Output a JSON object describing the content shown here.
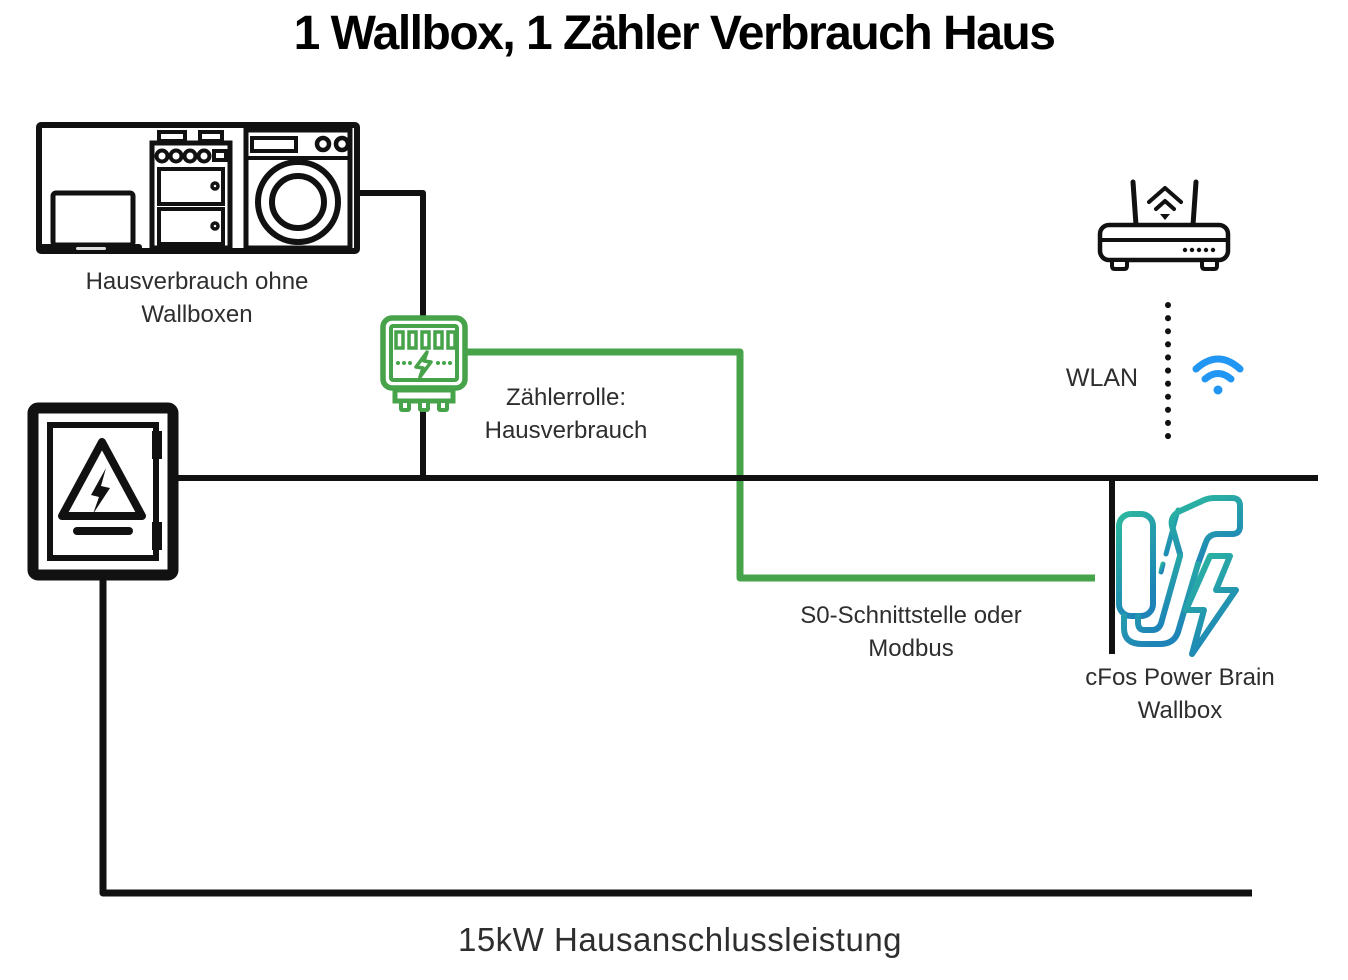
{
  "title": "1 Wallbox, 1 Zähler Verbrauch Haus",
  "nodes": {
    "house": {
      "label_line1": "Hausverbrauch ohne",
      "label_line2": "Wallboxen"
    },
    "meter": {
      "label_line1": "Zählerrolle:",
      "label_line2": "Hausverbrauch"
    },
    "wlan": {
      "label": "WLAN"
    },
    "s0_link": {
      "label_line1": "S0-Schnittstelle oder",
      "label_line2": "Modbus"
    },
    "wallbox": {
      "label_line1": "cFos Power Brain",
      "label_line2": "Wallbox"
    },
    "supply": {
      "label": "15kW Hausanschlussleistung"
    }
  },
  "icons": [
    "laptop-icon",
    "stove-icon",
    "washing-machine-icon",
    "fuse-box-icon",
    "power-meter-icon",
    "router-icon",
    "wifi-signal-icon",
    "wallbox-charger-icon",
    "lightning-bolt-icon"
  ],
  "colors": {
    "line_black": "#111111",
    "green": "#46a34a",
    "wifi_blue": "#2196f3",
    "teal_start": "#2cb99e",
    "teal_end": "#1e84b8",
    "text_color": "#2e2e2e",
    "title_color": "#000000"
  }
}
